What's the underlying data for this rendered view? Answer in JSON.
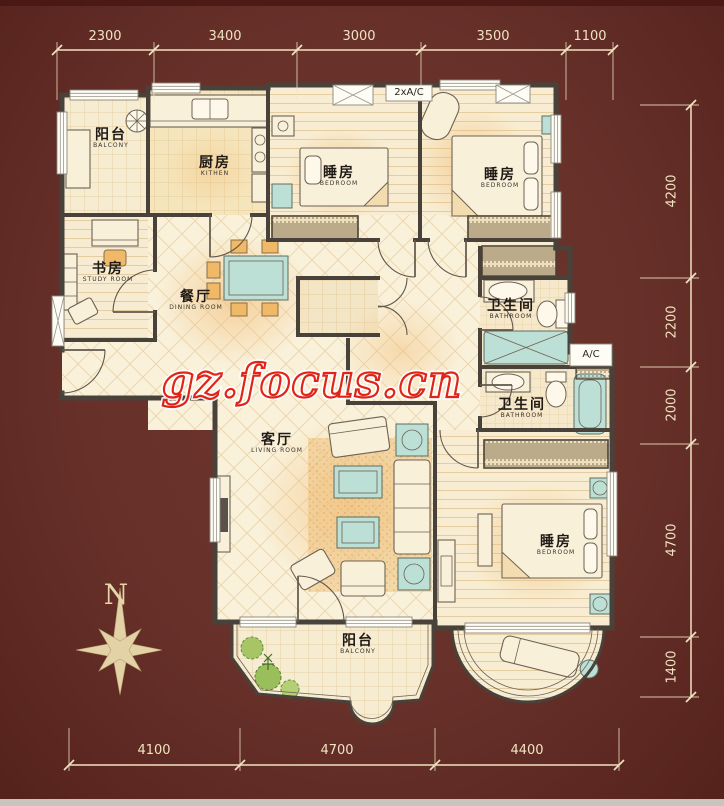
{
  "canvas": {
    "background": "#67312a",
    "wall_color": "#49423a",
    "floor_color": "#f8efd6",
    "dimension_color": "#f0e3c2"
  },
  "watermark": {
    "text": "gz.focus.cn",
    "color": "#e02418"
  },
  "compass": {
    "north_label": "N"
  },
  "ac_labels": {
    "top": "2xA/C",
    "right": "A/C"
  },
  "dimensions": {
    "top": [
      "2300",
      "3400",
      "3000",
      "3500",
      "1100"
    ],
    "right": [
      "4200",
      "2200",
      "2000",
      "4700",
      "1400"
    ],
    "bottom": [
      "4100",
      "4700",
      "4400"
    ]
  },
  "rooms": [
    {
      "id": "balcony-top-left",
      "zh": "阳台",
      "en": "BALCONY"
    },
    {
      "id": "kitchen",
      "zh": "厨房",
      "en": "KITHEN"
    },
    {
      "id": "bedroom-top-middle",
      "zh": "睡房",
      "en": "BEDROOM"
    },
    {
      "id": "bedroom-top-right",
      "zh": "睡房",
      "en": "BEDROOM"
    },
    {
      "id": "study",
      "zh": "书房",
      "en": "STUDY ROOM"
    },
    {
      "id": "dining",
      "zh": "餐厅",
      "en": "DINING ROOM"
    },
    {
      "id": "bathroom-upper",
      "zh": "卫生间",
      "en": "BATHROOM"
    },
    {
      "id": "bathroom-lower",
      "zh": "卫生间",
      "en": "BATHROOM"
    },
    {
      "id": "living",
      "zh": "客厅",
      "en": "LIVING ROOM"
    },
    {
      "id": "bedroom-bottom-right",
      "zh": "睡房",
      "en": "BEDROOM"
    },
    {
      "id": "balcony-bottom",
      "zh": "阳台",
      "en": "BALCONY"
    }
  ]
}
